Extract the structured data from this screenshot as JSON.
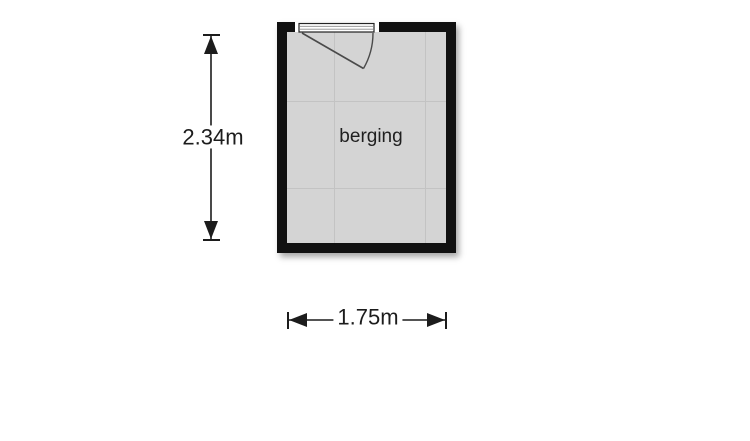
{
  "floorplan": {
    "room": {
      "label": "berging",
      "wall_color": "#111111",
      "floor_color": "#d4d4d4",
      "grid_color": "#c3c3c3"
    },
    "dimensions": {
      "vertical_label": "2.34m",
      "horizontal_label": "1.75m",
      "line_color": "#1c1c1c"
    },
    "door": {
      "icon": "door-swing-icon",
      "stroke_color": "#4a4a4a"
    },
    "page_background": "#ffffff"
  }
}
